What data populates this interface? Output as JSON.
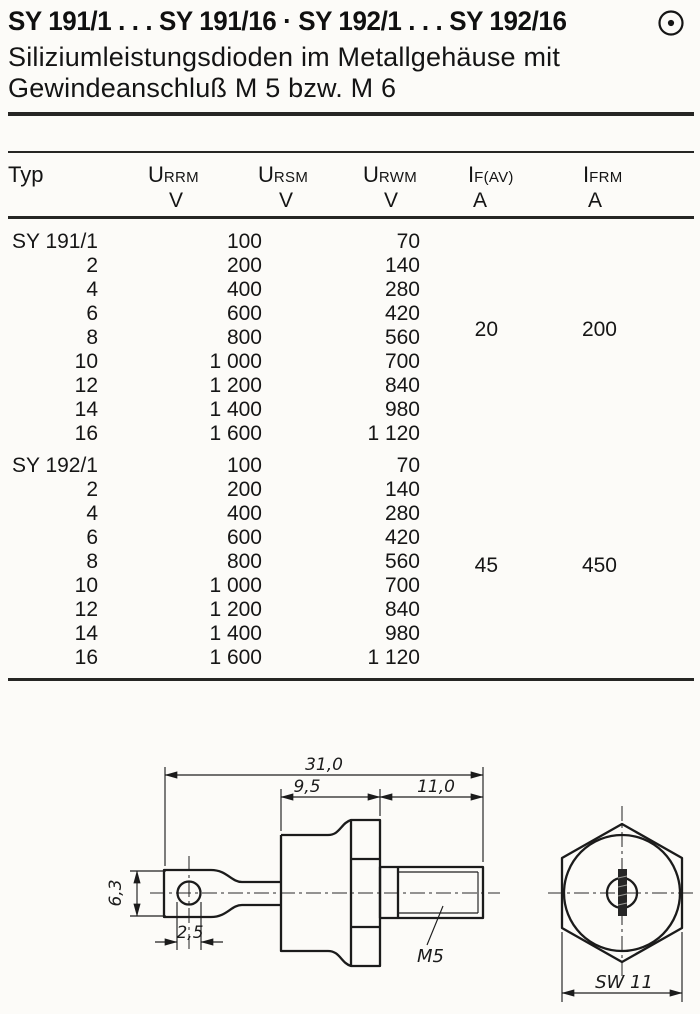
{
  "header": {
    "title": "SY 191/1 . . . SY 191/16 · SY 192/1 . . . SY 192/16",
    "subtitle_line1": "Siliziumleistungsdioden im Metallgehäuse mit",
    "subtitle_line2": "Gewindeanschluß M 5 bzw. M 6",
    "corner_icon": "circle-dot"
  },
  "table": {
    "columns": [
      {
        "label": "Typ",
        "sym": "Typ",
        "sub": "",
        "unit": ""
      },
      {
        "sym": "U",
        "sub": "RRM",
        "unit": "V"
      },
      {
        "sym": "U",
        "sub": "RSM",
        "unit": "V"
      },
      {
        "sym": "U",
        "sub": "RWM",
        "unit": "V"
      },
      {
        "sym": "I",
        "sub": "F(AV)",
        "unit": "A"
      },
      {
        "sym": "I",
        "sub": "FRM",
        "unit": "A"
      }
    ],
    "blocks": [
      {
        "series": "SY 191",
        "if_av": "20",
        "ifrm": "200",
        "rows": [
          {
            "typ": "SY 191/1",
            "urrm": "100",
            "ursm": "",
            "urwm": "70"
          },
          {
            "typ": "2",
            "urrm": "200",
            "ursm": "",
            "urwm": "140"
          },
          {
            "typ": "4",
            "urrm": "400",
            "ursm": "",
            "urwm": "280"
          },
          {
            "typ": "6",
            "urrm": "600",
            "ursm": "",
            "urwm": "420"
          },
          {
            "typ": "8",
            "urrm": "800",
            "ursm": "",
            "urwm": "560"
          },
          {
            "typ": "10",
            "urrm": "1 000",
            "ursm": "",
            "urwm": "700"
          },
          {
            "typ": "12",
            "urrm": "1 200",
            "ursm": "",
            "urwm": "840"
          },
          {
            "typ": "14",
            "urrm": "1 400",
            "ursm": "",
            "urwm": "980"
          },
          {
            "typ": "16",
            "urrm": "1 600",
            "ursm": "",
            "urwm": "1 120"
          }
        ]
      },
      {
        "series": "SY 192",
        "if_av": "45",
        "ifrm": "450",
        "rows": [
          {
            "typ": "SY 192/1",
            "urrm": "100",
            "ursm": "",
            "urwm": "70"
          },
          {
            "typ": "2",
            "urrm": "200",
            "ursm": "",
            "urwm": "140"
          },
          {
            "typ": "4",
            "urrm": "400",
            "ursm": "",
            "urwm": "280"
          },
          {
            "typ": "6",
            "urrm": "600",
            "ursm": "",
            "urwm": "420"
          },
          {
            "typ": "8",
            "urrm": "800",
            "ursm": "",
            "urwm": "560"
          },
          {
            "typ": "10",
            "urrm": "1 000",
            "ursm": "",
            "urwm": "700"
          },
          {
            "typ": "12",
            "urrm": "1 200",
            "ursm": "",
            "urwm": "840"
          },
          {
            "typ": "14",
            "urrm": "1 400",
            "ursm": "",
            "urwm": "980"
          },
          {
            "typ": "16",
            "urrm": "1 600",
            "ursm": "",
            "urwm": "1 120"
          }
        ]
      }
    ]
  },
  "drawing": {
    "dims": {
      "overall_length": "31,0",
      "body_length": "9,5",
      "stud_length": "11,0",
      "lug_height": "6,3",
      "hole_diameter": "2,5",
      "thread": "M5",
      "wrench_size": "SW 11"
    }
  }
}
